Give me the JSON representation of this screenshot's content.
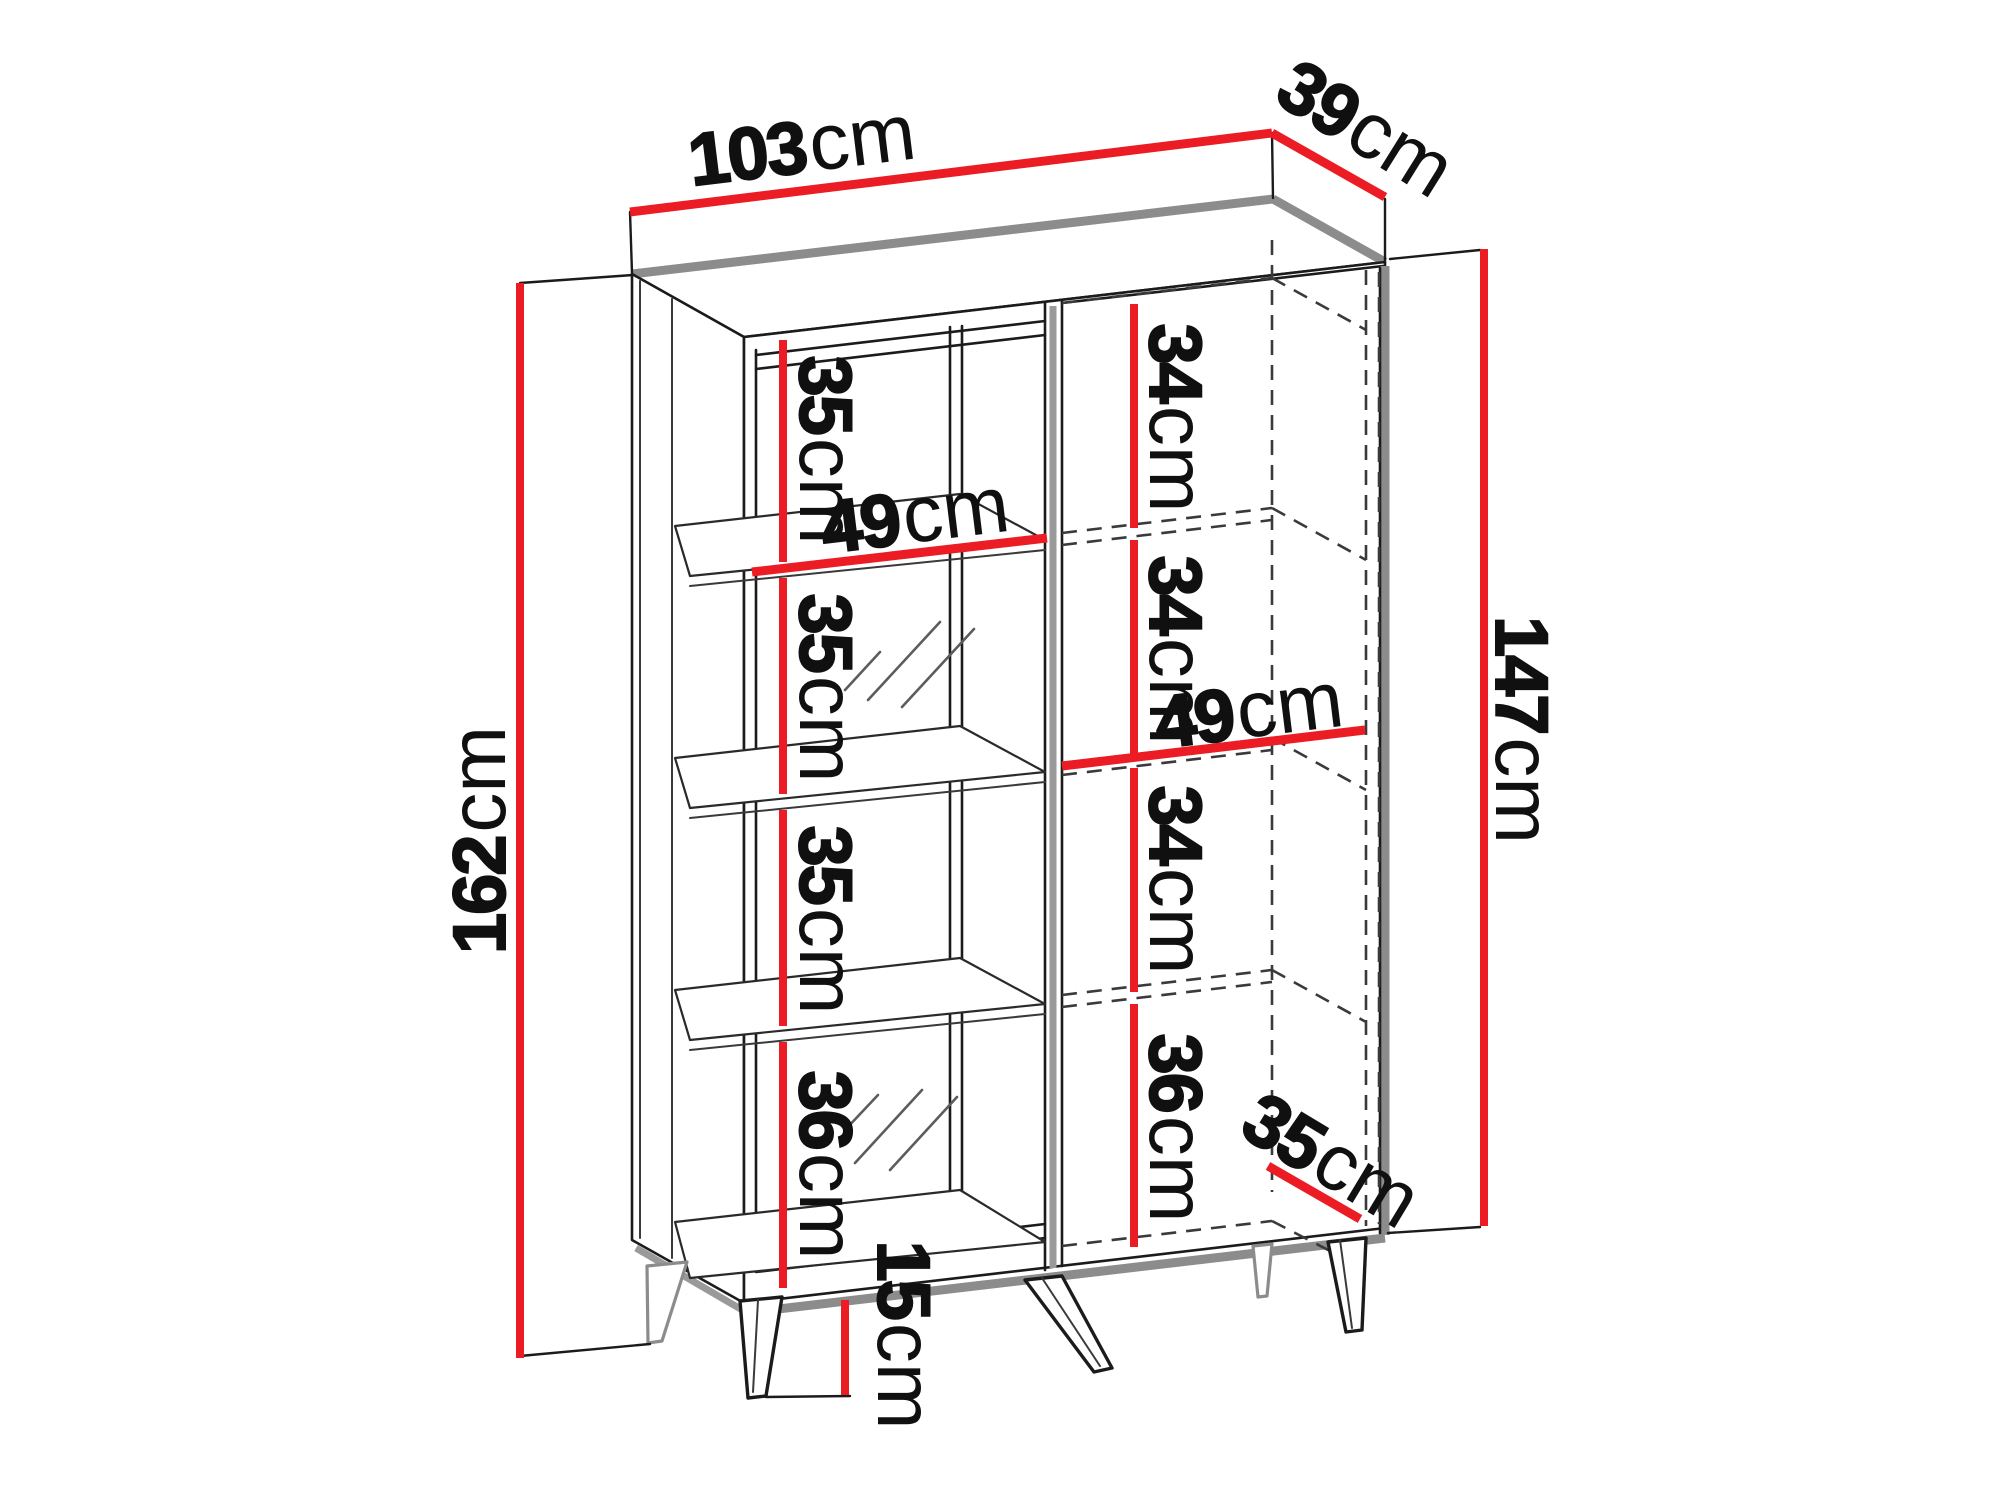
{
  "diagram": {
    "type": "furniture-dimension-diagram",
    "subject": "display cabinet with glass door, shelves and legs",
    "unit_label": "cm",
    "colors": {
      "dimension_red": "#EC1C24",
      "outline_black": "#1b1b1b",
      "shadow_gray": "#8c8c8c",
      "hidden_dash_gray": "#3a3a3a",
      "background": "#ffffff"
    },
    "dimensions": {
      "total_width": "103",
      "total_depth": "39",
      "total_height": "162",
      "body_height": "147",
      "left_shelf_width": "49",
      "right_shelf_width": "49",
      "interior_depth": "35",
      "leg_height": "15",
      "left_compartment_heights": [
        "35",
        "35",
        "35",
        "36"
      ],
      "right_compartment_heights": [
        "34",
        "34",
        "34",
        "36"
      ]
    }
  }
}
